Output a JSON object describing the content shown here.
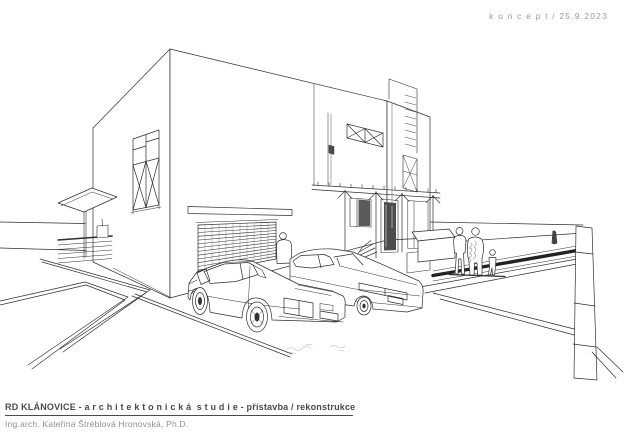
{
  "header": {
    "concept_date_label": "k o n c e p t / 25.9.2023"
  },
  "footer": {
    "title": "RD KLÁNOVICE - a r c h i t e k t o n i c k á  s t u d i e - přístavba / rekonstrukce",
    "architect_line": "Ing.arch. Kateřina Štréblová Hronovská, Ph.D."
  },
  "colors": {
    "paper": "#ffffff",
    "ink": "#2f2f2f",
    "light_ink": "#8a8a8a",
    "concept_label_gray": "#9a9a9a",
    "title_gray": "#4a4a4a",
    "subtitle_gray": "#8f8f8f"
  }
}
